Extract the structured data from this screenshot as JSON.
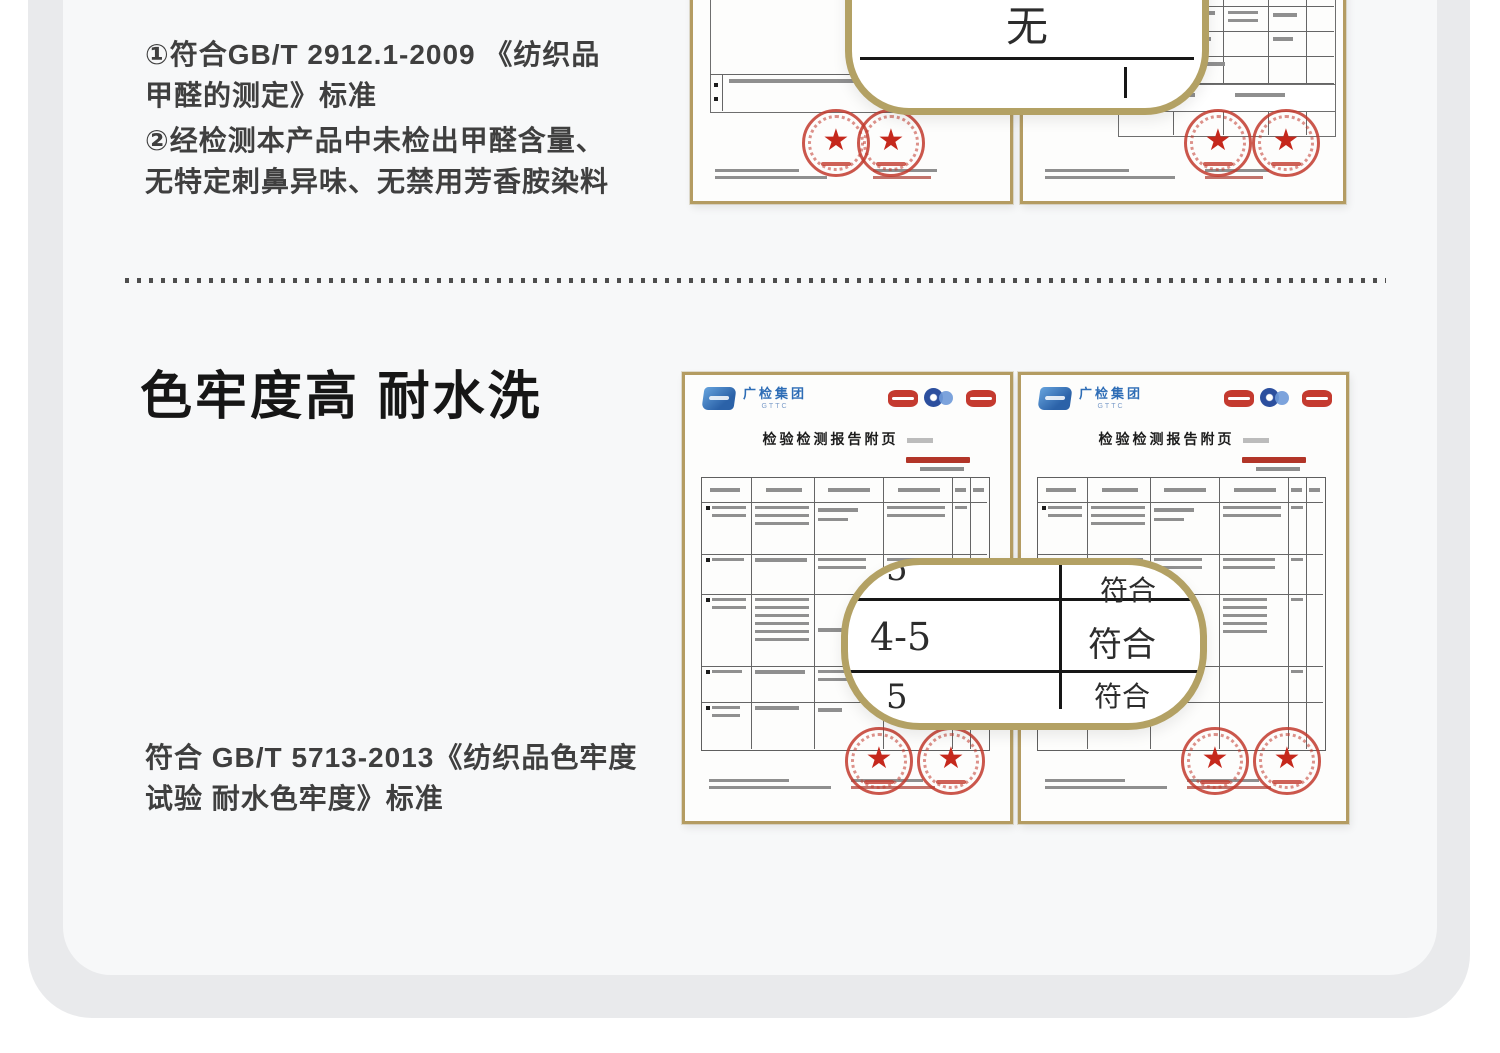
{
  "theme": {
    "panel_gray": "#e9eaec",
    "card_gray": "#f7f8f9",
    "gold_border": "#b3a164",
    "stamp_red": "#c13a2e",
    "brand_blue": "#2e6db6",
    "text_dark": "#3f3f3f"
  },
  "formaldehyde_section": {
    "point1_line1": "①符合GB/T 2912.1-2009 《纺织品",
    "point1_line2": "甲醛的测定》标准",
    "point2_line1": "②经检测本产品中未检出甲醛含量、",
    "point2_line2": "无特定刺鼻异味、无禁用芳香胺染料",
    "callout_value": "无"
  },
  "colorfast_section": {
    "heading": "色牢度高 耐水洗",
    "standard_line1": "符合 GB/T 5713-2013《纺织品色牢度",
    "standard_line2": "试验  耐水色牢度》标准",
    "callout_rows": [
      {
        "grade": "5",
        "verdict": "符合"
      },
      {
        "grade": "4-5",
        "verdict": "符合"
      },
      {
        "grade": "5",
        "verdict": "符合"
      }
    ]
  },
  "certificate": {
    "brand": "广检集团",
    "brand_sub": "GTTC",
    "title": "检验检测报告附页"
  }
}
